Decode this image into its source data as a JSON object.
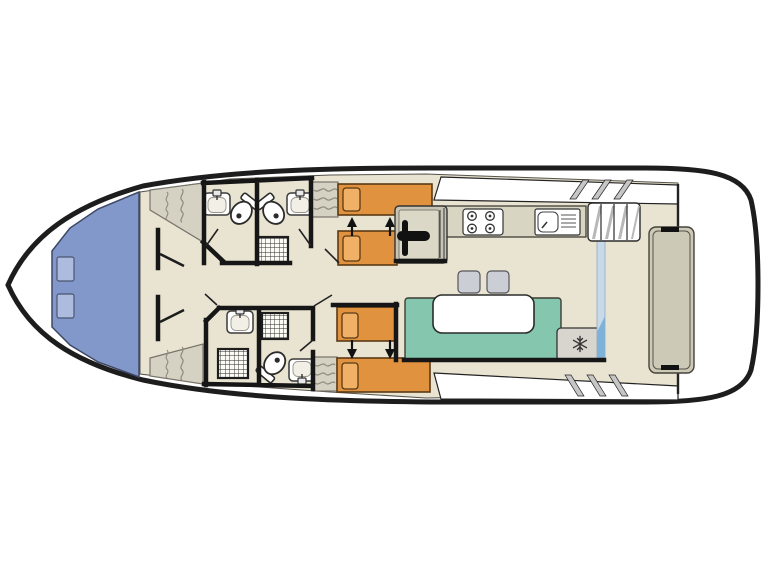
{
  "page": {
    "kind": "boat-deck-plan-diagram",
    "background": "#ffffff"
  },
  "colors": {
    "hull_line": "#1d1d1d",
    "deck_white": "#ffffff",
    "cabin_floor": "#e9e4d1",
    "floor_edge": "#55524a",
    "fore_deck_blue": "#8298ca",
    "hatch_blue": "#adbbde",
    "wall_black": "#161616",
    "furniture_gray": "#d6d2c3",
    "console_gray": "#c8c4b4",
    "console_inner": "#dcd8c8",
    "squiggle_gray": "#8f8b7e",
    "bed_orange": "#e0923f",
    "pillow_orange": "#f0b065",
    "bed_edge_brown": "#5a3a14",
    "counter_beige": "#d9d5c3",
    "fixture_white": "#ffffff",
    "seating_green": "#84c6ae",
    "table_white": "#ffffff",
    "stool_gray": "#ccced6",
    "fridge_gray": "#d8d5cf",
    "glass_light_blue": "#c8daea",
    "glass_accent_blue": "#7fb2d9",
    "step_shading_gray": "#b8b8b8",
    "stripe_gray": "#c6c6c6",
    "stern_bench_gray": "#cdc9b7"
  },
  "features": [
    "bow-sun-deck",
    "deck-hatches",
    "forward-cabin",
    "corner-wardrobes",
    "bathroom-forward-port",
    "bathroom-forward-starboard",
    "bathroom-aft-port",
    "toilets",
    "wash-basins",
    "showers",
    "twin-berths-starboard",
    "twin-berths-port",
    "convertible-bed-arrows",
    "helm-station",
    "steering-wheel",
    "galley-counter",
    "stove-four-burners",
    "galley-sink-with-drainer",
    "companionway-steps",
    "sliding-glass-door",
    "dinette-table",
    "dinette-bench",
    "stools",
    "fridge-freezer",
    "aft-deck",
    "stern-bench",
    "side-deck-windshield"
  ]
}
